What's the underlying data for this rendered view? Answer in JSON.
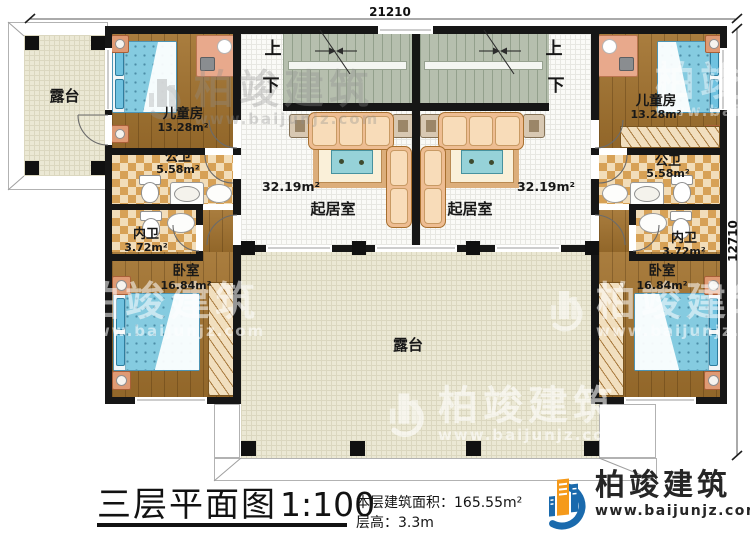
{
  "dimensions": {
    "width": "21210",
    "depth": "12710"
  },
  "stairs": {
    "up": "上",
    "down": "下"
  },
  "rooms": {
    "terrace": "露台",
    "kids": {
      "name": "儿童房",
      "area": "13.28m²"
    },
    "public_bath": {
      "name": "公卫",
      "area": "5.58m²"
    },
    "inner_bath": {
      "name": "内卫",
      "area": "3.72m²"
    },
    "bedroom": {
      "name": "卧室",
      "area": "16.84m²"
    },
    "living": {
      "name": "起居室",
      "area": "32.19m²"
    }
  },
  "title": {
    "name": "三层平面图",
    "scale": "1:100"
  },
  "info": {
    "area_label": "本层建筑面积：",
    "area_value": "165.55m²",
    "height_label": "层高：",
    "height_value": "3.3m"
  },
  "brand": {
    "name": "柏竣建筑",
    "site": "www.baijunjz.com"
  },
  "colors": {
    "wall": "#161616",
    "logo_blue": "#1a6aad",
    "logo_orange": "#f59a1b"
  }
}
